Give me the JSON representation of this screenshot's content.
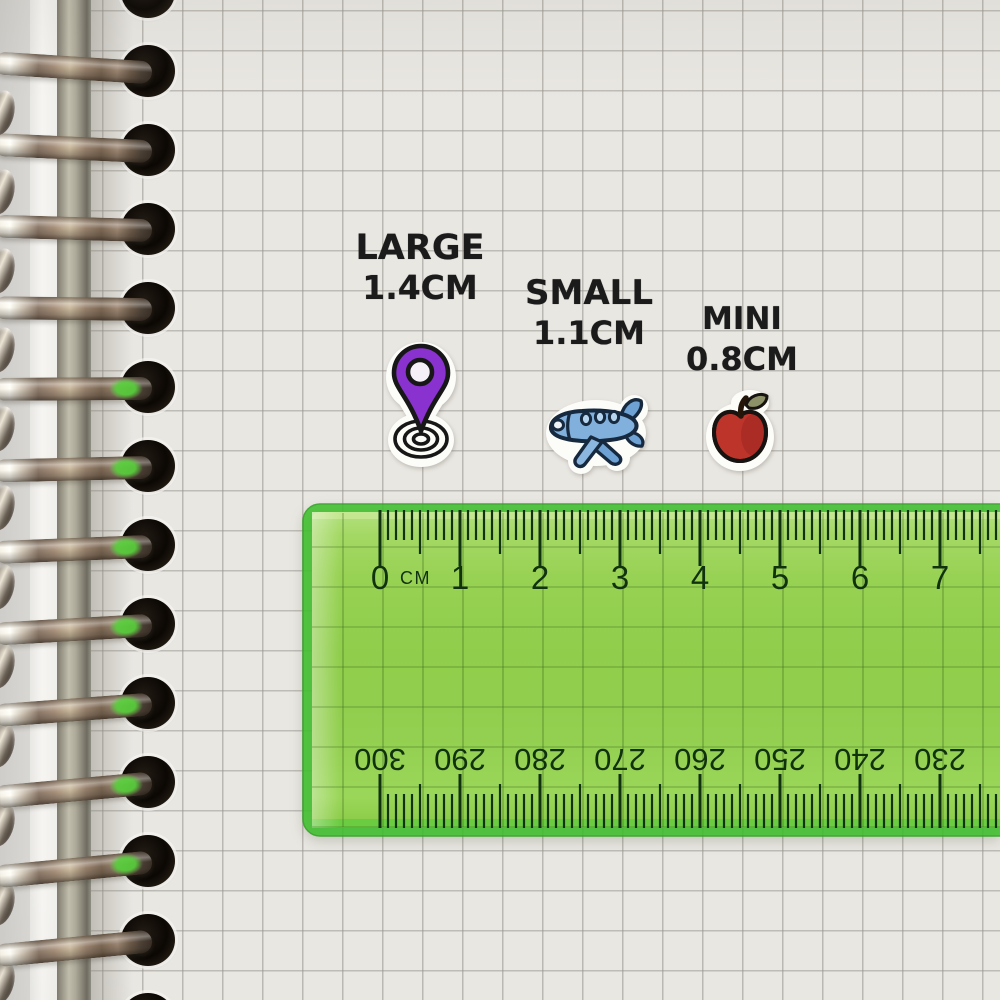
{
  "labels": [
    {
      "id": "large",
      "name_text": "LARGE",
      "size_text": "1.4CM"
    },
    {
      "id": "small",
      "name_text": "SMALL",
      "size_text": "1.1CM"
    },
    {
      "id": "mini",
      "name_text": "MINI",
      "size_text": "0.8CM"
    }
  ],
  "stickers": [
    {
      "name": "location-pin-sticker",
      "label": "LARGE",
      "size_cm": 1.4,
      "main_color": "#8a32cf"
    },
    {
      "name": "airplane-sticker",
      "label": "SMALL",
      "size_cm": 1.1,
      "main_color": "#82b0dd"
    },
    {
      "name": "apple-sticker",
      "label": "MINI",
      "size_cm": 0.8,
      "main_color": "#bd342b"
    }
  ],
  "ruler": {
    "unit_label": "CM",
    "top_numbers": [
      "0",
      "1",
      "2",
      "3",
      "4",
      "5",
      "6",
      "7"
    ],
    "bottom_numbers": [
      "300",
      "290",
      "280",
      "270",
      "260",
      "250",
      "240",
      "230"
    ],
    "body_color": "#9ad255",
    "edge_color": "#3fc02e",
    "marking_color": "#11320f"
  },
  "paper": {
    "color": "#e9e7e2",
    "grid_color": "#94918a"
  },
  "binding": {
    "ring_count": 13,
    "material_color": "#cfc4b4"
  }
}
